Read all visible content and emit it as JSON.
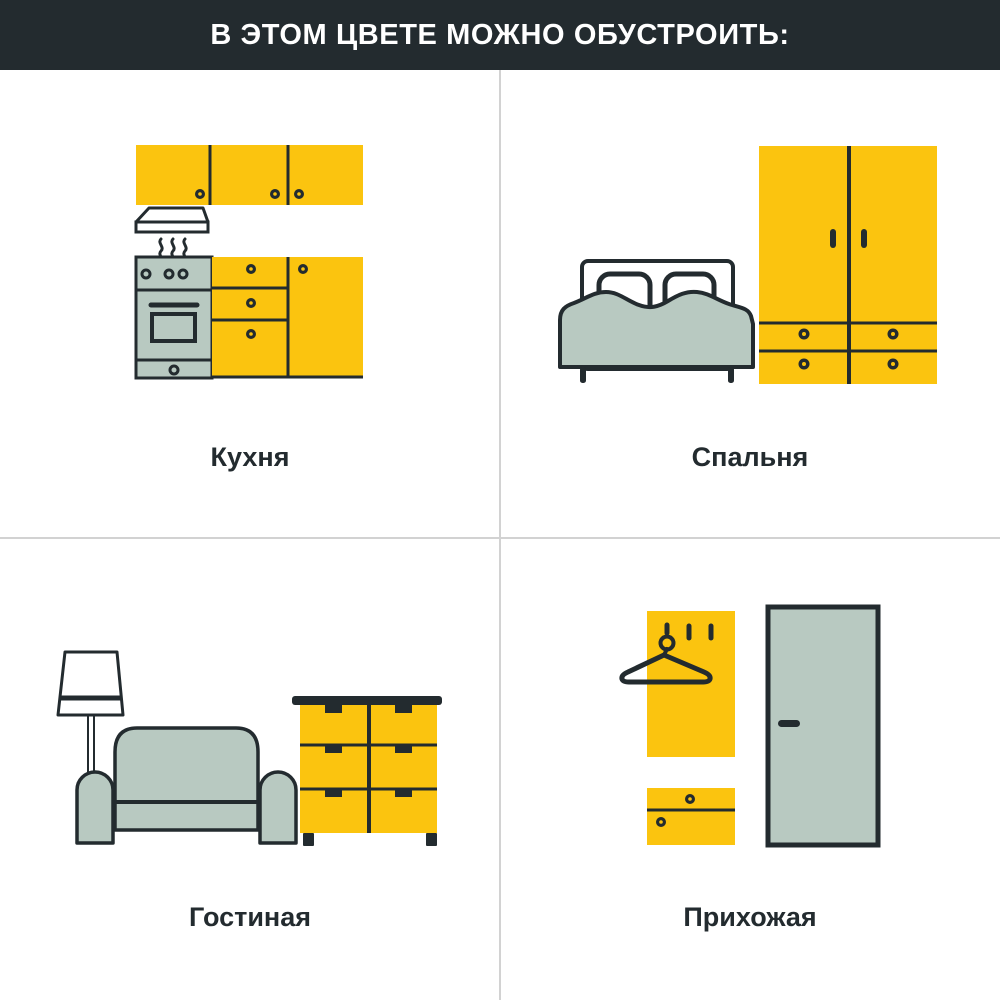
{
  "header": {
    "title": "В ЭТОМ ЦВЕТЕ МОЖНО ОБУСТРОИТЬ:"
  },
  "rooms": [
    {
      "id": "kitchen",
      "label": "Кухня",
      "icon": "kitchen-illustration"
    },
    {
      "id": "bedroom",
      "label": "Спальня",
      "icon": "bedroom-illustration"
    },
    {
      "id": "living-room",
      "label": "Гостиная",
      "icon": "living-room-illustration"
    },
    {
      "id": "hallway",
      "label": "Прихожая",
      "icon": "hallway-illustration"
    }
  ],
  "colors": {
    "header_bg": "#232B2F",
    "header_text": "#FFFFFF",
    "accent_yellow": "#FBC40F",
    "muted_green": "#B8C9C1",
    "outline_dark": "#232B2F",
    "divider": "#D2D2D2"
  }
}
